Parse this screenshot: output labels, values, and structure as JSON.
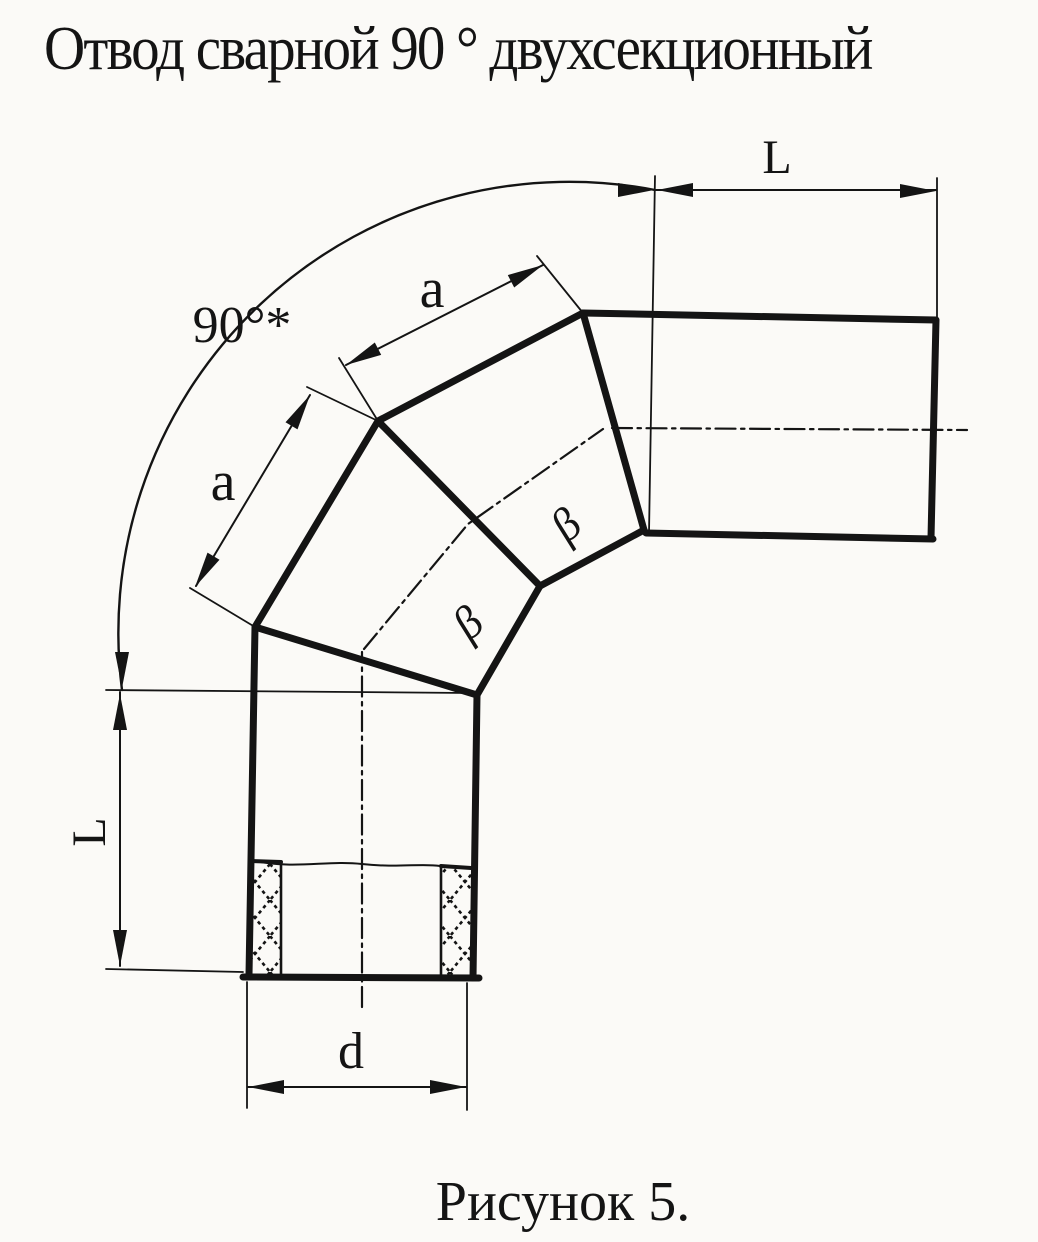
{
  "title": "Отвод сварной 90 ° двухсекционный",
  "caption": "Рисунок 5.",
  "labels": {
    "length_top": "L",
    "length_left": "L",
    "angle": "90°*",
    "segment_upper": "a",
    "segment_lower": "a",
    "diameter": "d",
    "bevel_upper": "β",
    "bevel_lower": "β"
  },
  "colors": {
    "ink": "#141414",
    "paper": "#fbfaf7"
  }
}
